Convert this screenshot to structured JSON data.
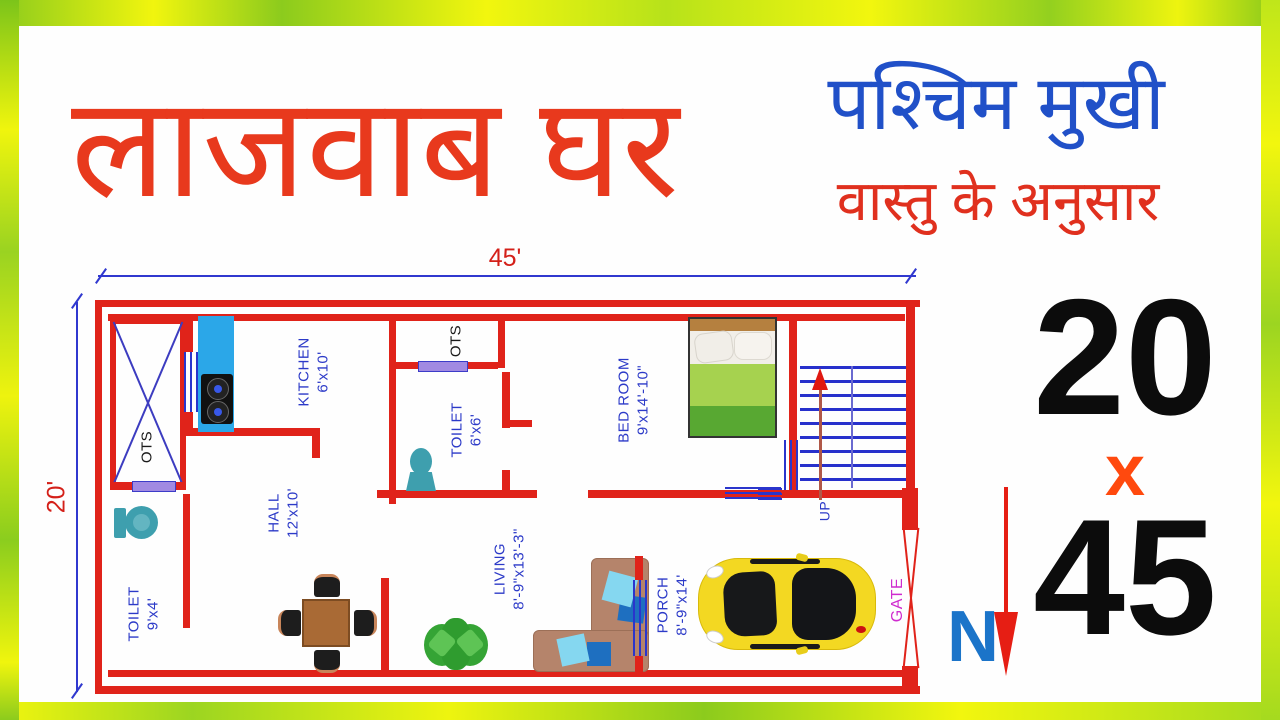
{
  "header": {
    "main_title": "लाजवाब घर",
    "subtitle_line1": "पश्चिम मुखी",
    "subtitle_line2": "वास्तु के अनुसार"
  },
  "dimensions": {
    "top_width": "45'",
    "left_height": "20'"
  },
  "plot_size": {
    "first": "20",
    "times": "x",
    "second": "45",
    "north_label": "N"
  },
  "floorplan": {
    "rooms": {
      "ots_top_left": {
        "name": "OTS"
      },
      "kitchen": {
        "name": "KITCHEN",
        "size": "6'x10'"
      },
      "ots_mid": {
        "name": "OTS"
      },
      "toilet_mid": {
        "name": "TOILET",
        "size": "6'x6'"
      },
      "bedroom": {
        "name": "BED ROOM",
        "size": "9'x14'-10\""
      },
      "toilet_left": {
        "name": "TOILET",
        "size": "9'x4'"
      },
      "hall": {
        "name": "HALL",
        "size": "12'x10'"
      },
      "living": {
        "name": "LIVING",
        "size": "8'-9\"x13'-3\""
      },
      "porch": {
        "name": "PORCH",
        "size": "8'-9\"x14'"
      },
      "stairs": {
        "up_label": "UP"
      },
      "gate": {
        "name": "GATE"
      }
    }
  },
  "colors": {
    "wall_red": "#e0231a",
    "title_orange": "#e8391d",
    "subtitle_blue": "#2050c8",
    "subtitle_red": "#e0301e",
    "label_blue": "#2c3ac8",
    "gate_magenta": "#cf2ccf",
    "dimension_blue": "#3038cf",
    "fixture_teal": "#3e9fae",
    "counter_blue": "#2ba7e8",
    "car_yellow": "#f3d822",
    "times_orange": "#ff490e",
    "north_blue": "#1b74c9",
    "border_yellow": "#f2f60e",
    "border_green": "#8ccb1d"
  }
}
